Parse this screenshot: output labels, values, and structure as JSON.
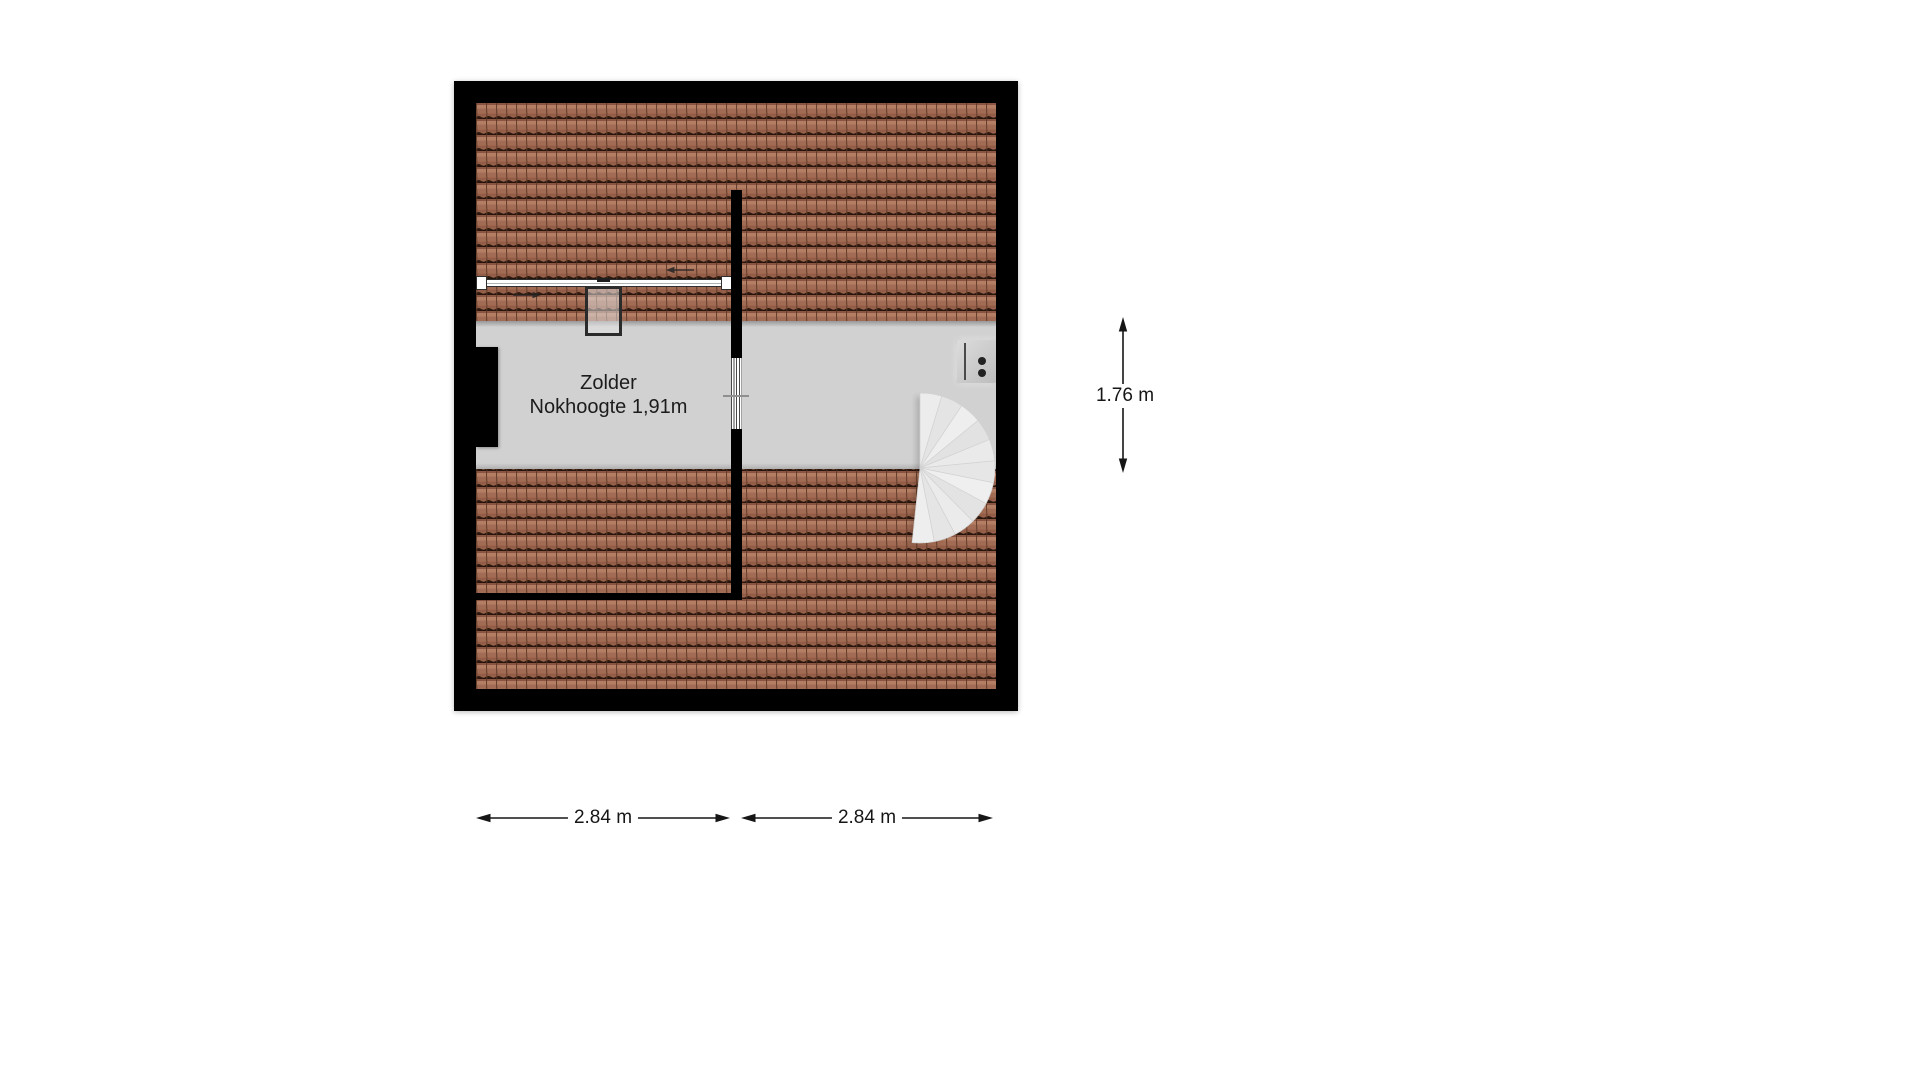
{
  "room": {
    "name": "Zolder",
    "subtitle": "Nokhoogte 1,91m"
  },
  "dimensions": {
    "bottom_left": {
      "label": "2.84 m",
      "orientation": "horizontal"
    },
    "bottom_right": {
      "label": "2.84 m",
      "orientation": "horizontal"
    },
    "right": {
      "label": "1.76 m",
      "orientation": "vertical"
    }
  },
  "symbols": {
    "roof": "roof-tiles-pattern",
    "staircase": "spiral-staircase",
    "skylight": "roof-window",
    "rail": "roof-rail",
    "chimney": "chimney-block",
    "wall_unit": "wall-mounted-unit-two-dots",
    "door": "hatched-door-opening",
    "flow_arrows": [
      "arrow-right",
      "arrow-left"
    ]
  },
  "colors": {
    "page": "#ffffff",
    "wall": "#000000",
    "floor": "#d1d1d1",
    "tile_base": "#a26b53",
    "tile_highlight": "#b37e64",
    "tile_shadow": "#2e1a10",
    "stair": "#e9e9e9",
    "dim": "#161616",
    "text": "#1c1c1c"
  }
}
